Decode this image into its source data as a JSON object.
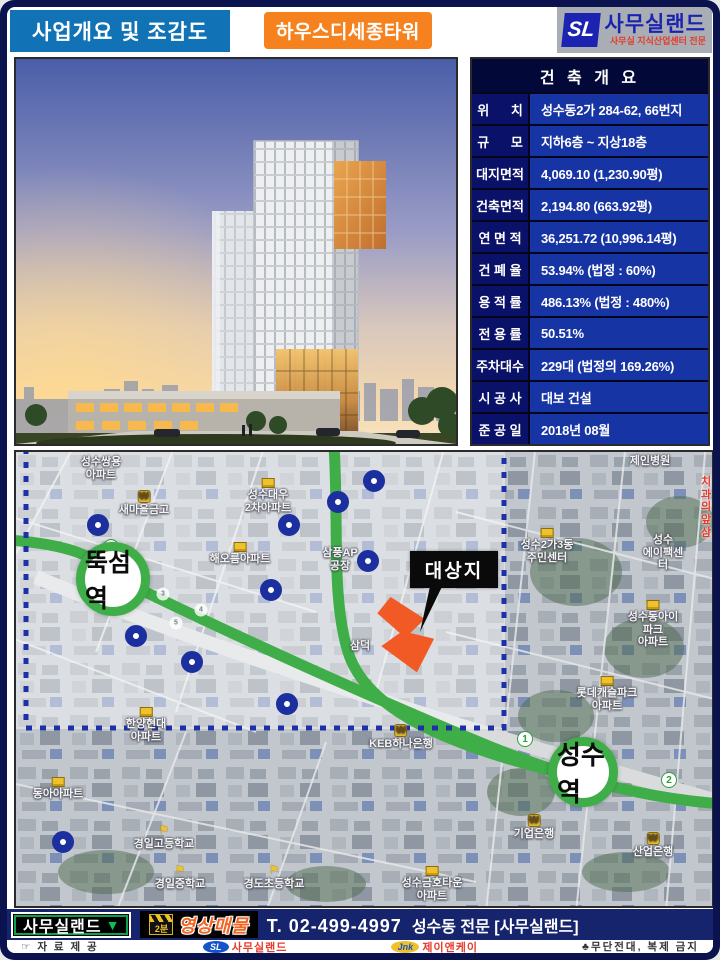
{
  "header": {
    "section_title": "사업개요 및 조감도",
    "building_name": "하우스디세종타워",
    "logo": {
      "mark": "SL",
      "name": "사무실랜드",
      "subtitle": "사무실 지식산업센터 전문"
    }
  },
  "table": {
    "title": "건 축 개 요",
    "rows": [
      {
        "label": "위      치",
        "value": "성수동2가 284-62, 66번지"
      },
      {
        "label": "규      모",
        "value": "지하6층 ~ 지상18층"
      },
      {
        "label": "대지면적",
        "value": "4,069.10 (1,230.90평)"
      },
      {
        "label": "건축면적",
        "value": "2,194.80 (663.92평)"
      },
      {
        "label": "연 면 적",
        "value": "36,251.72 (10,996.14평)"
      },
      {
        "label": "건 폐 율",
        "value": "53.94% (법정 : 60%)"
      },
      {
        "label": "용 적 률",
        "value": "486.13% (법정 : 480%)"
      },
      {
        "label": "전 용 률",
        "value": "50.51%"
      },
      {
        "label": "주차대수",
        "value": "229대 (법정의 169.26%)"
      },
      {
        "label": "시 공 사",
        "value": "대보 건설"
      },
      {
        "label": "준 공 일",
        "value": "2018년 08월"
      }
    ]
  },
  "map": {
    "stations": [
      {
        "name": "뚝섬역",
        "x": 97,
        "y": 127,
        "r": 46,
        "font": 25
      },
      {
        "name": "성수역",
        "x": 567,
        "y": 320,
        "r": 44,
        "font": 26
      }
    ],
    "target_label": "대상지",
    "line_badges": [
      {
        "n": "1",
        "x": 95,
        "y": 95,
        "size": 16,
        "style": "line"
      },
      {
        "n": "1",
        "x": 509,
        "y": 287,
        "size": 16,
        "style": "line"
      },
      {
        "n": "2",
        "x": 653,
        "y": 328,
        "size": 16,
        "style": "line"
      },
      {
        "n": "3",
        "x": 147,
        "y": 142,
        "size": 13,
        "style": "stop"
      },
      {
        "n": "4",
        "x": 185,
        "y": 158,
        "size": 13,
        "style": "stop"
      },
      {
        "n": "5",
        "x": 160,
        "y": 171,
        "size": 13,
        "style": "stop"
      }
    ],
    "poi_markers": [
      [
        82,
        73
      ],
      [
        273,
        73
      ],
      [
        322,
        50
      ],
      [
        358,
        29
      ],
      [
        255,
        138
      ],
      [
        352,
        109
      ],
      [
        120,
        184
      ],
      [
        176,
        210
      ],
      [
        271,
        252
      ],
      [
        47,
        390
      ]
    ],
    "labels": [
      {
        "text": "성수쌍용\n아파트",
        "x": 85,
        "y": 4
      },
      {
        "text": "새마을금고",
        "x": 128,
        "y": 38,
        "icon": "won"
      },
      {
        "text": "성수대우\n2차아파트",
        "x": 252,
        "y": 26,
        "icon": "bldg"
      },
      {
        "text": "해오름아파트",
        "x": 224,
        "y": 90,
        "icon": "bldg"
      },
      {
        "text": "삼풍AP\n공장",
        "x": 324,
        "y": 95
      },
      {
        "text": "삼덕",
        "x": 344,
        "y": 188
      },
      {
        "text": "한양현대\n아파트",
        "x": 130,
        "y": 255,
        "icon": "bldg"
      },
      {
        "text": "동아아파트",
        "x": 42,
        "y": 325,
        "icon": "bldg"
      },
      {
        "text": "경일고등학교",
        "x": 148,
        "y": 372,
        "icon": "flag"
      },
      {
        "text": "경일중학교",
        "x": 164,
        "y": 412,
        "icon": "flag"
      },
      {
        "text": "경도초등학교",
        "x": 258,
        "y": 412,
        "icon": "flag"
      },
      {
        "text": "KEB하나은행",
        "x": 385,
        "y": 272,
        "icon": "won"
      },
      {
        "text": "기업은행",
        "x": 518,
        "y": 362,
        "icon": "won"
      },
      {
        "text": "산업은행",
        "x": 637,
        "y": 380,
        "icon": "won"
      },
      {
        "text": "성수금호타운\n아파트",
        "x": 416,
        "y": 414,
        "icon": "bldg"
      },
      {
        "text": "제인병원",
        "x": 634,
        "y": 3
      },
      {
        "text": "치과의\n앞삼",
        "x": 690,
        "y": 24,
        "color": "red"
      },
      {
        "text": "성수2가3동\n주민센터",
        "x": 531,
        "y": 76,
        "icon": "bldg"
      },
      {
        "text": "성수\n에이팩센터",
        "x": 647,
        "y": 82
      },
      {
        "text": "성수동아이파크\n아파트",
        "x": 637,
        "y": 148,
        "icon": "bldg"
      },
      {
        "text": "롯데캐슬파크\n아파트",
        "x": 591,
        "y": 224,
        "icon": "bldg"
      }
    ]
  },
  "bottom_bar": {
    "brand": "사무실랜드",
    "brand_arrow": "▼",
    "video_minutes": "2분",
    "video_label": "영상매물",
    "phone": "T. 02-499-4997",
    "tagline": "성수동 전문 [사무실랜드]"
  },
  "footer": {
    "source": "☞ 자 료 제 공",
    "sl_mark": "SL",
    "sl_name": "사무실랜드",
    "jnk_mark": "Jnk",
    "jnk_name": "제이앤케이",
    "notice": "♣무단전대, 복제 금지"
  },
  "colors": {
    "accent_blue": "#1173b6",
    "accent_orange": "#f5821f",
    "table_label_bg": "#0a1168",
    "table_value_bg": "#1734a4",
    "line_green": "#3fae49",
    "marker_blue": "#1c2f9e",
    "site_orange": "#f15a24"
  }
}
